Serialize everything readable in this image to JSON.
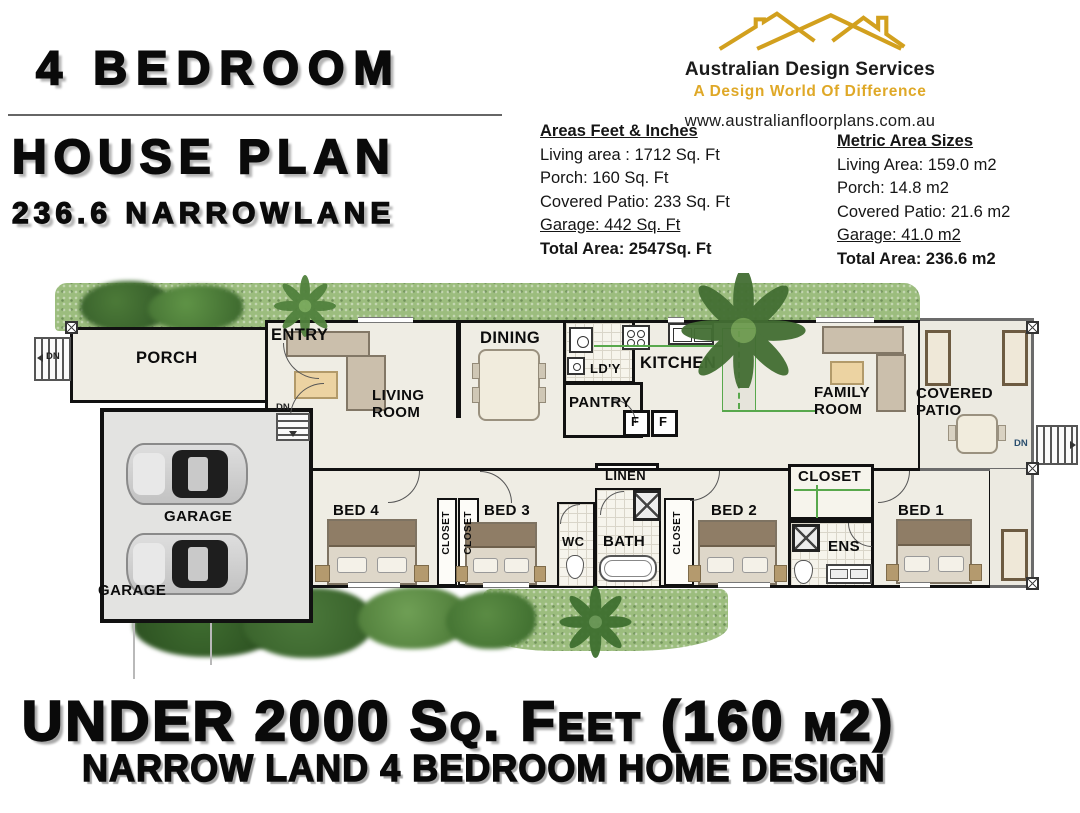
{
  "header": {
    "title_line1": "4 BEDROOM",
    "title_line2": "HOUSE PLAN",
    "title_line3": "236.6 NARROWLANE"
  },
  "brand": {
    "name": "Australian Design Services",
    "tagline": "A Design World Of Difference",
    "website": "www.australianfloorplans.com.au",
    "gold": "#D2A01E"
  },
  "areas_imperial": {
    "heading": "Areas Feet & Inches",
    "lines": [
      "Living  area : 1712 Sq. Ft",
      "Porch: 160 Sq. Ft",
      "Covered Patio: 233 Sq. Ft",
      "Garage: 442 Sq. Ft"
    ],
    "total": "Total Area:   2547Sq. Ft"
  },
  "areas_metric": {
    "heading": "Metric Area Sizes",
    "lines": [
      "Living Area: 159.0 m2",
      "Porch: 14.8 m2",
      "Covered Patio: 21.6 m2",
      "Garage: 41.0 m2"
    ],
    "total": "Total Area:   236.6 m2"
  },
  "plan": {
    "labels": {
      "porch": "PORCH",
      "entry": "ENTRY",
      "living": "LIVING\nROOM",
      "dining": "DINING",
      "laundry": "LD'Y",
      "kitchen": "KITCHEN",
      "pantry": "PANTRY",
      "family": "FAMILY\nROOM",
      "patio": "COVERED\nPATIO",
      "garage": "GARAGE",
      "garage2": "GARAGE",
      "bed4": "BED 4",
      "bed3": "BED 3",
      "bed2": "BED 2",
      "bed1": "BED 1",
      "closet": "CLOSET",
      "wc": "WC",
      "bath": "BATH",
      "linen": "LINEN",
      "ens": "ENS",
      "fridge": "F",
      "dn": "DN"
    },
    "colors": {
      "wall": "#111111",
      "bench_green": "#58a84c",
      "patio_gray": "#6b6b6b"
    }
  },
  "footer": {
    "line1": "UNDER 2000 Sq. Feet (160 m2)",
    "line2": "NARROW LAND 4 BEDROOM HOME DESIGN"
  }
}
